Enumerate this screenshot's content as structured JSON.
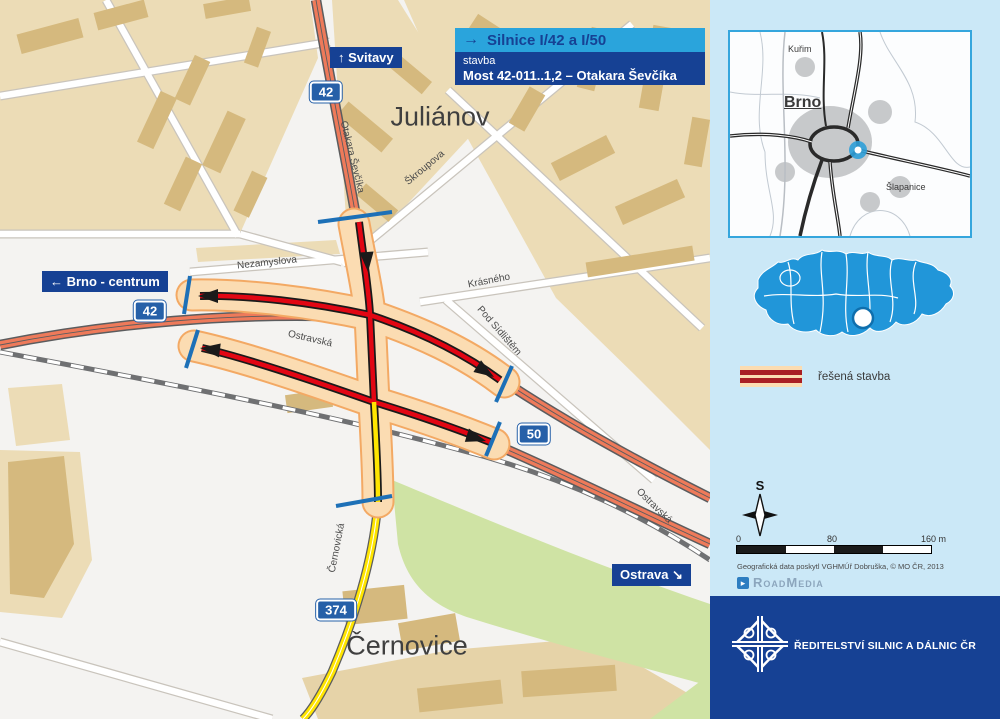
{
  "header": {
    "arrow": "→",
    "route_title": "Silnice I/42 a I/50",
    "stavba_label": "stavba",
    "project_name": "Most 42-011..1,2 – Otakara Ševčíka"
  },
  "map": {
    "direction_signs": [
      {
        "text": "↑ Svitavy"
      },
      {
        "text": "← Brno - centrum"
      },
      {
        "text": "Ostrava ↘"
      }
    ],
    "road_shields": [
      {
        "number": "42"
      },
      {
        "number": "42"
      },
      {
        "number": "50"
      },
      {
        "number": "374"
      }
    ],
    "district_labels": [
      {
        "text": "Juliánov"
      },
      {
        "text": "Černovice"
      }
    ],
    "street_labels": [
      {
        "text": "Otakara Ševčíka"
      },
      {
        "text": "Škroupova"
      },
      {
        "text": "Nezamyslova"
      },
      {
        "text": "Krásného"
      },
      {
        "text": "Pod Sídlištěm"
      },
      {
        "text": "Ostravská"
      },
      {
        "text": "Ostravská"
      },
      {
        "text": "Černovická"
      }
    ]
  },
  "sidebar": {
    "inset_map": {
      "towns": [
        {
          "name": "Kuřim"
        },
        {
          "name": "Brno"
        },
        {
          "name": "Šlapanice"
        }
      ]
    },
    "legend": {
      "label": "řešená stavba"
    },
    "compass": {
      "north_label": "S"
    },
    "scale_bar": {
      "labels": [
        "0",
        "80",
        "160 m"
      ]
    },
    "attribution": "Geografická data poskytl VGHMÚř Dobruška, © MO ČR, 2013",
    "credit": {
      "name": "RoadMedia"
    },
    "footer": {
      "organization": "ŘEDITELSTVÍ SILNIC A DÁLNIC ČR"
    }
  },
  "colors": {
    "construction_red": "#e20613",
    "corridor_band": "#fbdcb2",
    "band_edge": "#f3a964",
    "existing_road": "#ee7a5a",
    "minor_road_yellow": "#ffe500",
    "accent_blue": "#2aa4dc",
    "dark_blue": "#164194",
    "tick_blue": "#1d70b7",
    "czech_map_blue": "#2196d9",
    "sidebar_bg": "#cbe8f7"
  }
}
